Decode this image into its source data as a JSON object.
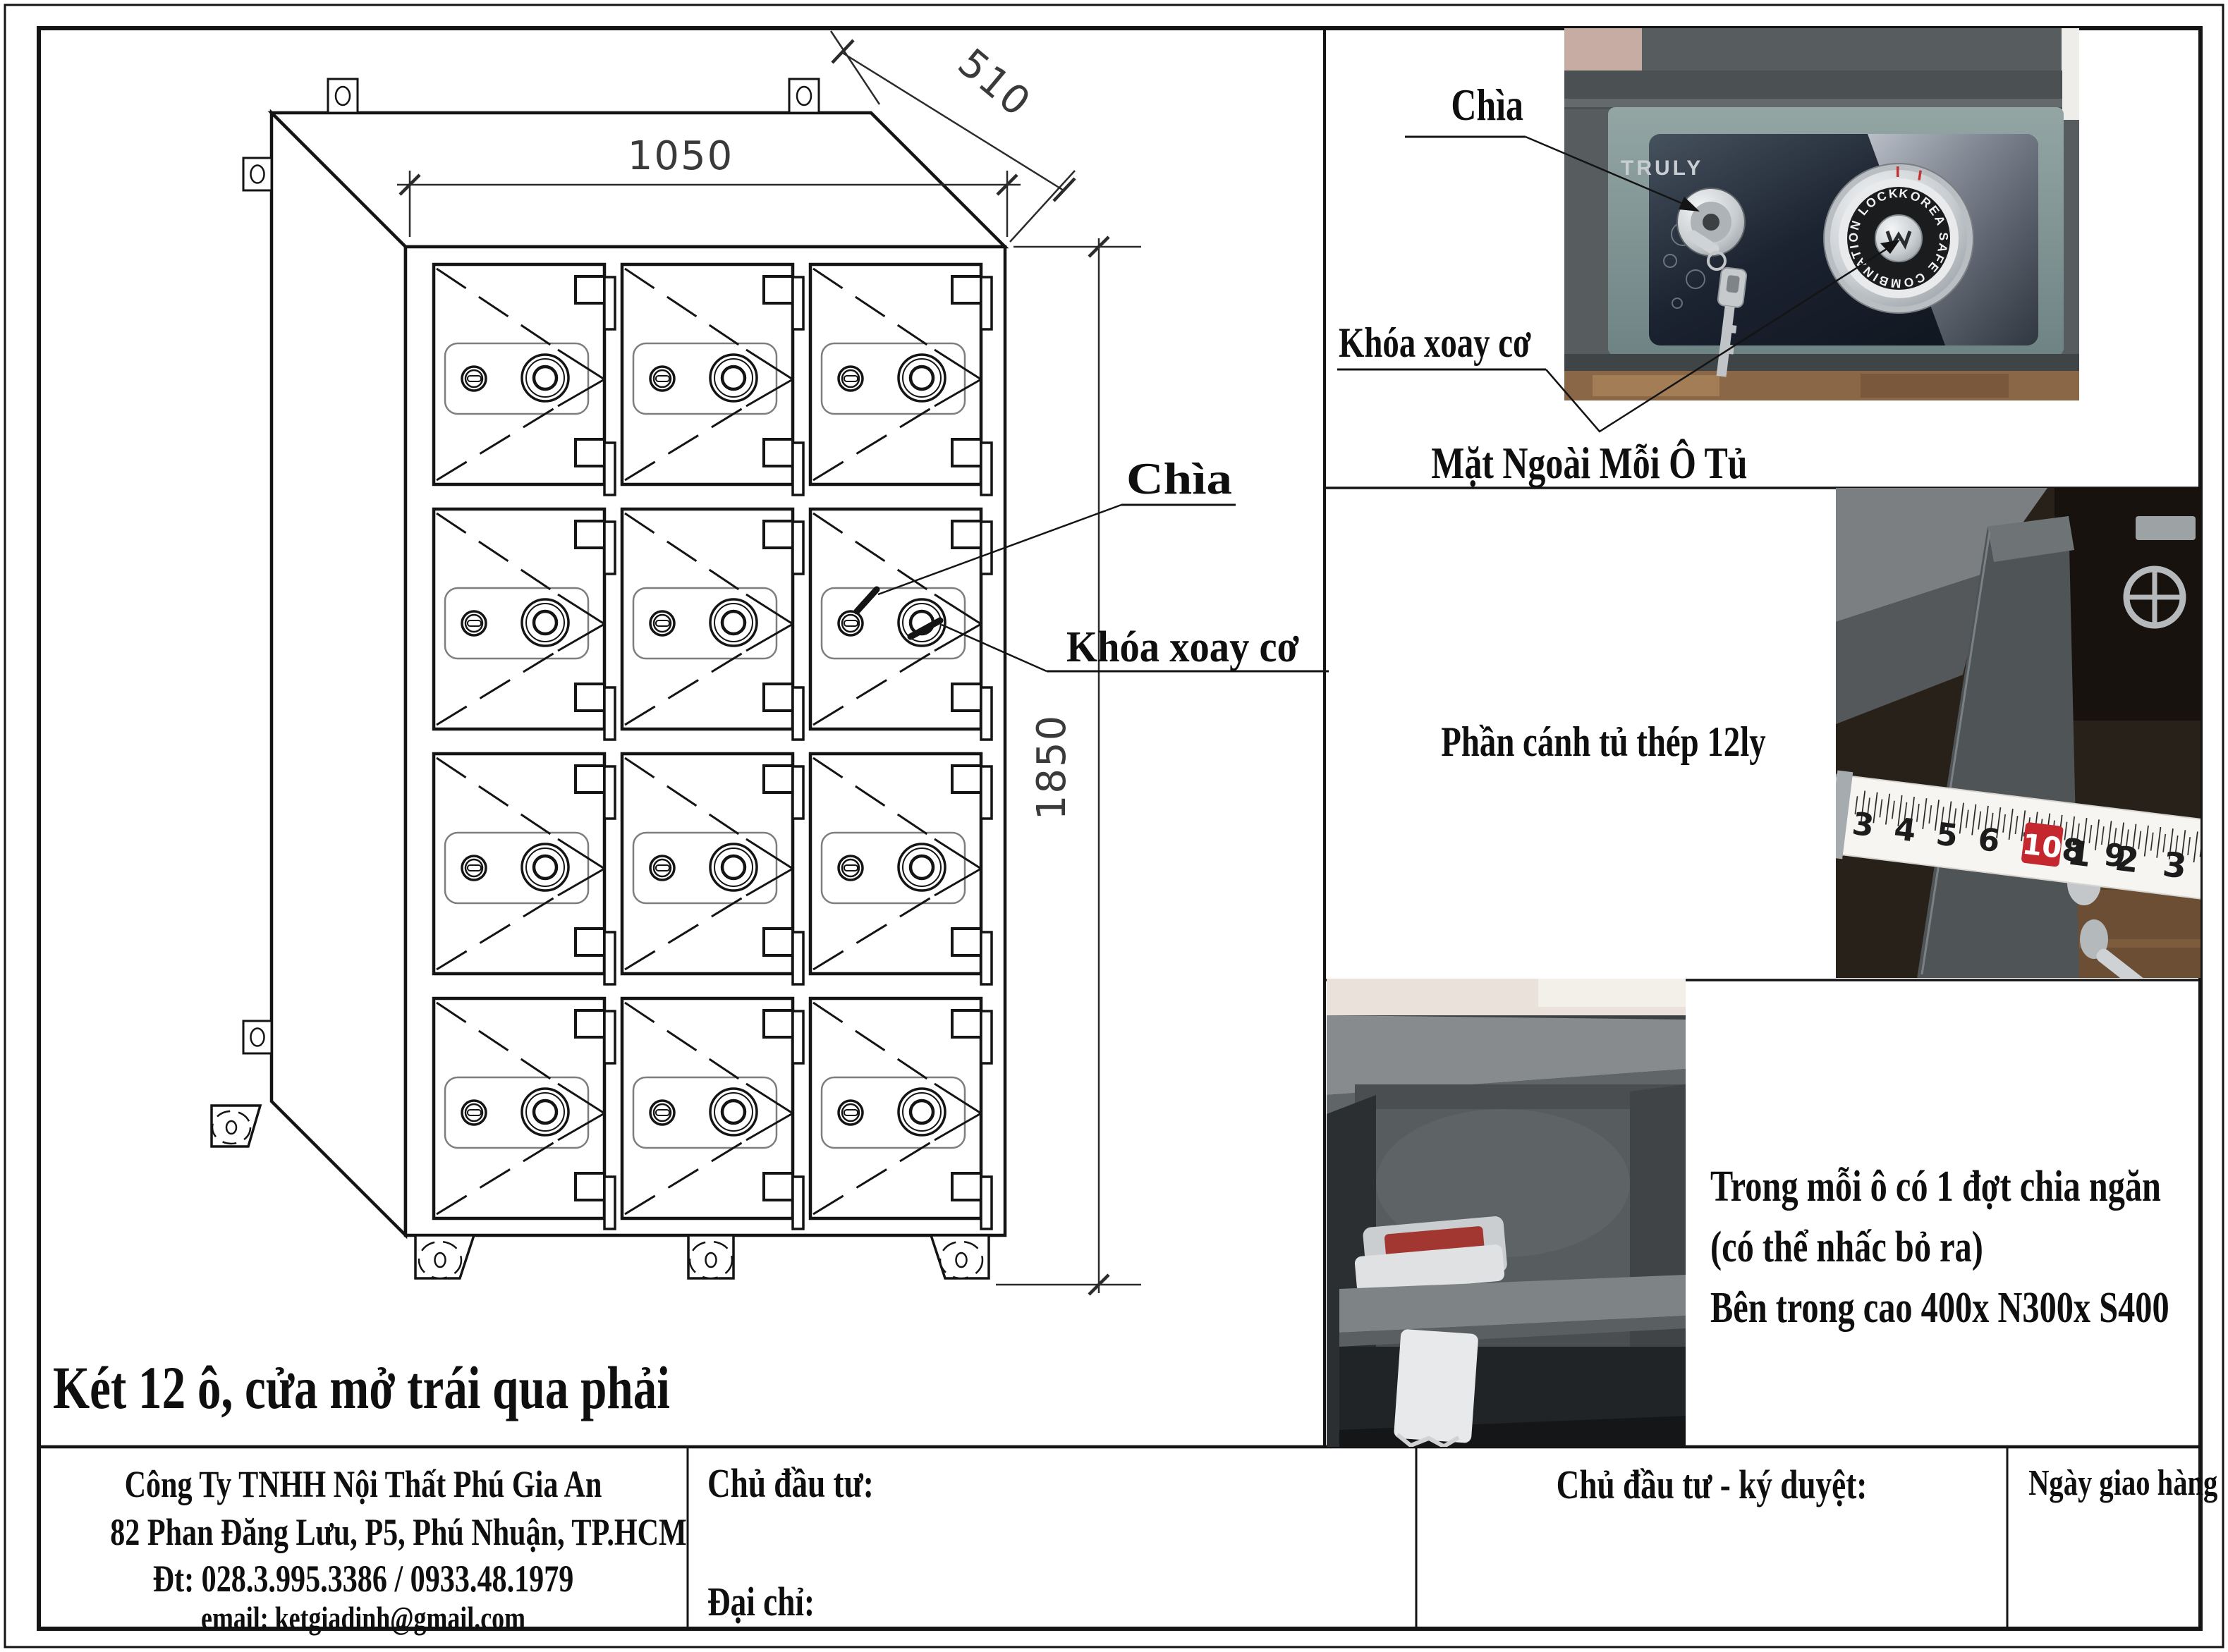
{
  "sheet": {
    "drawing": {
      "dim_width": "1050",
      "dim_depth": "510",
      "dim_height": "1850",
      "label_key": "Chìa",
      "label_dial": "Khóa xoay cơ",
      "caption": "Két 12 ô, cửa mở trái qua phải"
    },
    "photo_exterior": {
      "brand": "TRULY",
      "dial_ring_text": "KOREA SAFE COMBINATION LOCK",
      "label_key": "Chìa",
      "label_dial": "Khóa xoay cơ",
      "caption": "Mặt Ngoài Mỗi Ô Tủ"
    },
    "photo_door": {
      "note": "Phần cánh tủ thép 12ly",
      "tape_left": "3 4 5 6 7 8 9",
      "tape_ten": "10",
      "tape_right": "1 2 3 4 5 6 7"
    },
    "photo_interior": {
      "note1": "Trong mỗi ô có 1 đợt chia ngăn",
      "note2": "(có thể nhấc bỏ ra)",
      "note3": "Bên trong cao 400x N300x S400"
    },
    "title_block": {
      "company_name": "Công Ty TNHH Nội Thất Phú Gia An",
      "company_address": "82 Phan Đăng Lưu, P5, Phú Nhuận, TP.HCM",
      "company_phone": "Đt: 028.3.995.3386 / 0933.48.1979",
      "company_email": "email: ketgiadinh@gmail.com",
      "investor_label": "Chủ đầu tư:",
      "address_label": "Đại chỉ:",
      "approval_label": "Chủ đầu tư - ký duyệt:",
      "delivery_label": "Ngày giao hàng"
    }
  }
}
